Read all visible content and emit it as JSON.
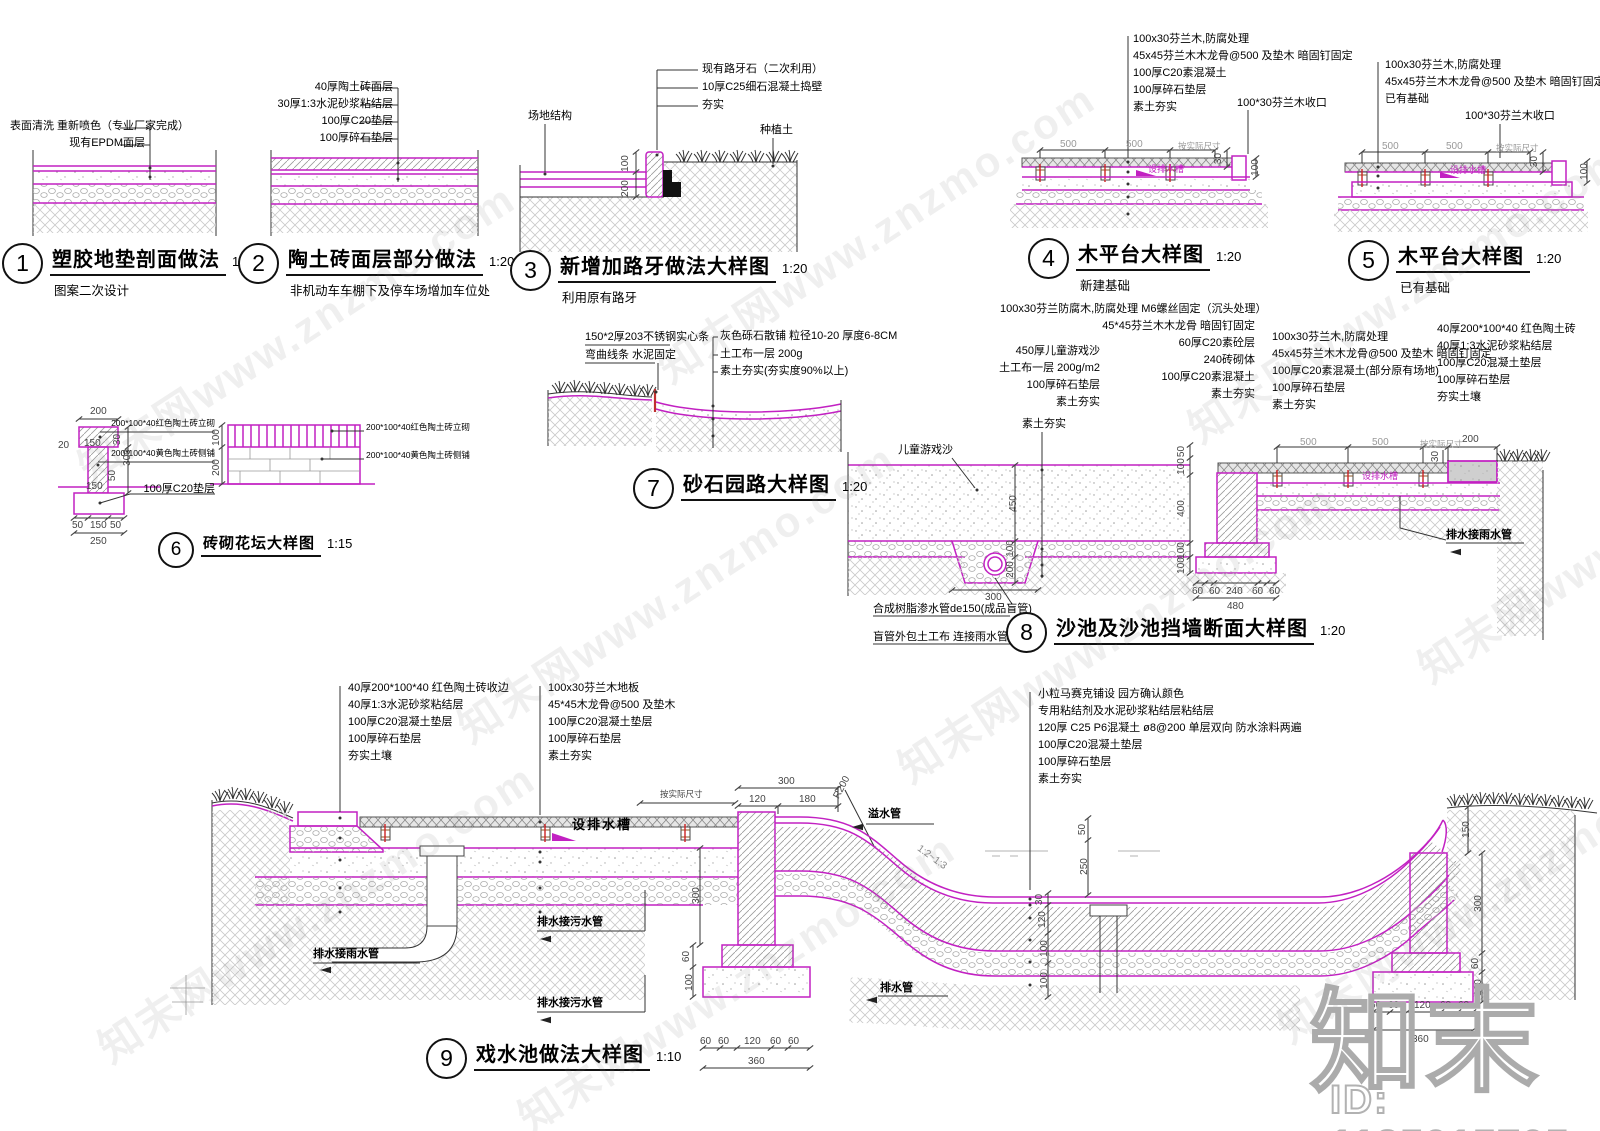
{
  "watermark": {
    "site": "知末网www.znzmo.com",
    "logo": "知末",
    "id": "ID: 1185015705"
  },
  "d1": {
    "num": "1",
    "title": "塑胶地垫剖面做法",
    "scale": "1:20",
    "subtitle": "图案二次设计",
    "labels": [
      "表面清洗 重新喷色（专业厂家完成）",
      "现有EPDM面层"
    ]
  },
  "d2": {
    "num": "2",
    "title": "陶土砖面层部分做法",
    "scale": "1:20",
    "subtitle": "非机动车车棚下及停车场增加车位处",
    "labels": [
      "40厚陶土砖面层",
      "30厚1:3水泥砂浆粘结层",
      "100厚C20垫层",
      "100厚碎石垫层"
    ]
  },
  "d3": {
    "num": "3",
    "title": "新增加路牙做法大样图",
    "scale": "1:20",
    "subtitle": "利用原有路牙",
    "labels": [
      "现有路牙石（二次利用）",
      "10厚C25细石混凝土捣壁",
      "夯实",
      "场地结构",
      "种植土"
    ],
    "dims": [
      "100",
      "200"
    ]
  },
  "d4": {
    "num": "4",
    "title": "木平台大样图",
    "scale": "1:20",
    "subtitle": "新建基础",
    "labels": [
      "100x30芬兰木,防腐处理",
      "45x45芬兰木木龙骨@500 及垫木 暗固钉固定",
      "100厚C20素混凝土",
      "100厚碎石垫层",
      "素土夯实"
    ],
    "label_edge": "100*30芬兰木收口",
    "note": "设排水槽",
    "dims": [
      "500",
      "500",
      "按实际尺寸",
      "30",
      "100"
    ]
  },
  "d5": {
    "num": "5",
    "title": "木平台大样图",
    "scale": "1:20",
    "subtitle": "已有基础",
    "labels": [
      "100x30芬兰木,防腐处理",
      "45x45芬兰木木龙骨@500 及垫木 暗固钉固定",
      "已有基础"
    ],
    "label_edge": "100*30芬兰木收口",
    "note": "设排水槽",
    "dims": [
      "500",
      "500",
      "按实际尺寸",
      "30",
      "100"
    ]
  },
  "d6": {
    "num": "6",
    "title": "砖砌花坛大样图",
    "scale": "1:15",
    "labels": [
      "200*100*40红色陶土砖立砌",
      "200*100*40黄色陶土砖侧铺",
      "100厚C20垫层"
    ],
    "labels_right": [
      "200*100*40红色陶土砖立砌",
      "200*100*40黄色陶土砖侧铺"
    ],
    "dims": [
      "200",
      "20",
      "150",
      "30",
      "300",
      "50",
      "150",
      "50",
      "150",
      "50",
      "250",
      "100",
      "200"
    ]
  },
  "d7": {
    "num": "7",
    "title": "砂石园路大样图",
    "scale": "1:20",
    "labels_left": [
      "150*2厚203不锈钢实心条",
      "弯曲线条 水泥固定"
    ],
    "labels_right": [
      "灰色砾石散铺 粒径10-20 厚度6-8CM",
      "土工布一层 200g",
      "素土夯实(夯实度90%以上)"
    ]
  },
  "d8": {
    "num": "8",
    "title": "沙池及沙池挡墙断面大样图",
    "scale": "1:20",
    "labels_sand": [
      "450厚儿童游戏沙",
      "土工布一层 200g/m2",
      "100厚碎石垫层",
      "素土夯实"
    ],
    "labels_wall": [
      "100x30芬兰防腐木,防腐处理 M6螺丝固定（沉头处理）",
      "45*45芬兰木木龙骨 暗固钉固定",
      "60厚C20素砼层",
      "240砖砌体",
      "100厚C20素混凝土",
      "素土夯实"
    ],
    "labels_deck": [
      "100x30芬兰木,防腐处理",
      "45x45芬兰木木龙骨@500 及垫木 暗固钉固定",
      "100厚C20素混凝土(部分原有场地)",
      "100厚碎石垫层",
      "素土夯实"
    ],
    "labels_brick": [
      "40厚200*100*40 红色陶土砖",
      "40厚1:3水泥砂浆粘结层",
      "100厚C20混凝土垫层",
      "100厚碎石垫层",
      "夯实土壤"
    ],
    "notes": [
      "儿童游戏沙",
      "素土夯实",
      "设排水槽",
      "排水接雨水管",
      "合成树脂渗水管de150(成品盲管)",
      "盲管外包土工布 连接雨水管网"
    ],
    "dims_sand": [
      "450",
      "100",
      "200",
      "300"
    ],
    "dims_wallv": [
      "50",
      "100",
      "400",
      "100",
      "100"
    ],
    "dims_wallb": [
      "60",
      "60",
      "240",
      "60",
      "60",
      "480"
    ],
    "dims_deck": [
      "500",
      "500",
      "按实际尺寸",
      "200",
      "30"
    ]
  },
  "d9": {
    "num": "9",
    "title": "戏水池做法大样图",
    "scale": "1:10",
    "labels_curb": [
      "40厚200*100*40 红色陶土砖收边",
      "40厚1:3水泥砂浆粘结层",
      "100厚C20混凝土垫层",
      "100厚碎石垫层",
      "夯实土壤"
    ],
    "labels_deck": [
      "100x30芬兰木地板",
      "45*45木龙骨@500 及垫木",
      "100厚C20混凝土垫层",
      "100厚碎石垫层",
      "素土夯实"
    ],
    "labels_pool": [
      "小粒马赛克铺设 园方确认颜色",
      "专用粘结剂及水泥砂浆粘结层粘结层",
      "120厚 C25 P6混凝土 ø8@200 单层双向 防水涂料两遍",
      "100厚C20混凝土垫层",
      "100厚碎石垫层",
      "素土夯实"
    ],
    "notes": [
      "设排水槽",
      "排水接雨水管",
      "排水接污水管",
      "排水接污水管",
      "溢水管",
      "排水管",
      "1:2~1:3",
      "R200"
    ],
    "dims_top": [
      "按实际尺寸",
      "300",
      "120",
      "180"
    ],
    "dims_pool": [
      "50",
      "250",
      "30",
      "120",
      "100",
      "100"
    ],
    "dims_left": [
      "300",
      "60",
      "100"
    ],
    "dims_foot": [
      "60",
      "60",
      "120",
      "60",
      "60",
      "360"
    ],
    "dims_right": [
      "150",
      "300",
      "60",
      "100"
    ],
    "dims_rfoot": [
      "60",
      "60",
      "120",
      "60",
      "60",
      "360"
    ]
  }
}
